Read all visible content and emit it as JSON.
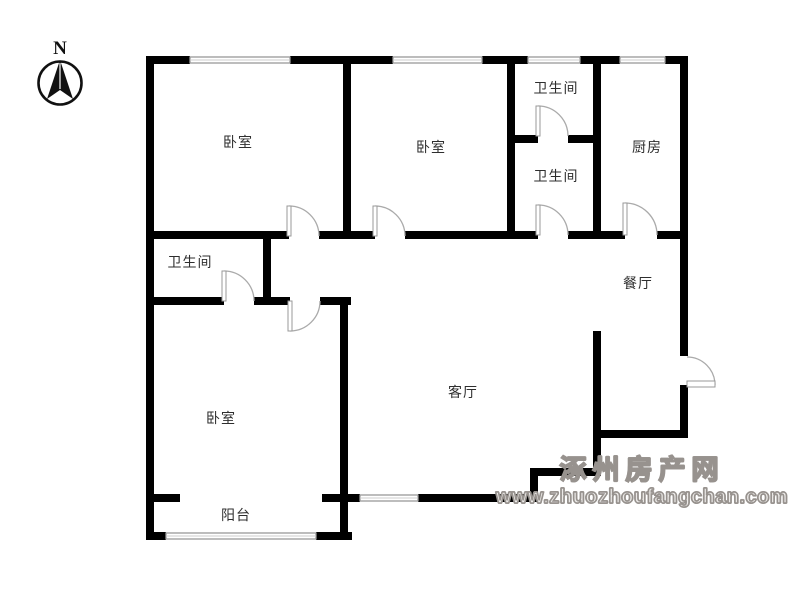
{
  "compass": {
    "label": "N"
  },
  "rooms": [
    {
      "id": "bedroom-1",
      "label": "卧室"
    },
    {
      "id": "bedroom-2",
      "label": "卧室"
    },
    {
      "id": "bathroom-top",
      "label": "卫生间"
    },
    {
      "id": "bathroom-middle",
      "label": "卫生间"
    },
    {
      "id": "kitchen",
      "label": "厨房"
    },
    {
      "id": "bathroom-ensuite",
      "label": "卫生间"
    },
    {
      "id": "dining-room",
      "label": "餐厅"
    },
    {
      "id": "living-room",
      "label": "客厅"
    },
    {
      "id": "bedroom-3",
      "label": "卧室"
    },
    {
      "id": "balcony",
      "label": "阳台"
    }
  ],
  "watermark": {
    "line1": "涿州房产网",
    "line2": "www.zhuozhoufangchan.com"
  },
  "colors": {
    "wall": "#000000",
    "window_stroke": "#999999",
    "door_stroke": "#aaaaaa",
    "label_text": "#2e2e2e",
    "watermark_fill": "#edebe9",
    "watermark_stroke": "#97928e",
    "background": "#ffffff"
  }
}
